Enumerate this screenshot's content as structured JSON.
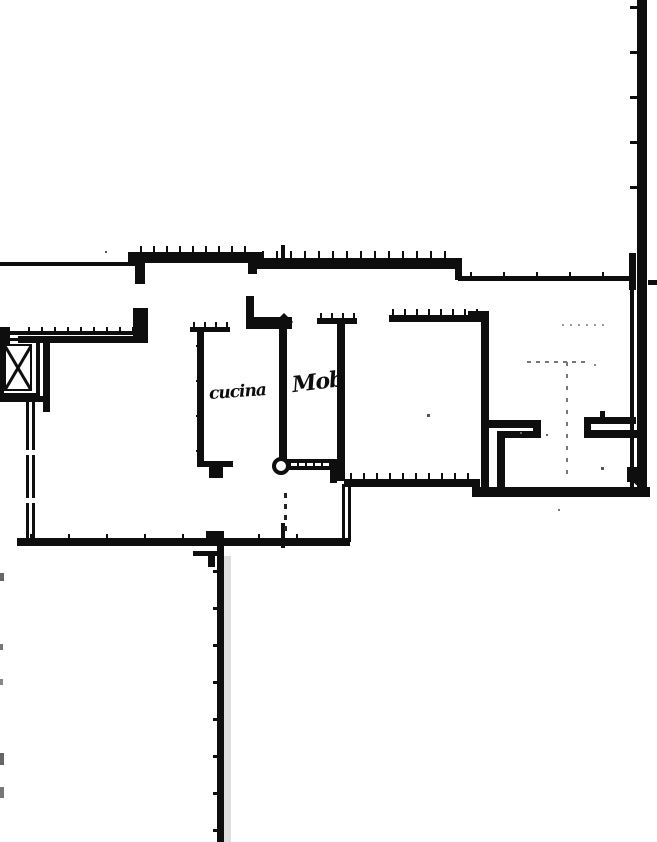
{
  "labels": {
    "kitchen": "cucina",
    "mob": "Mob"
  },
  "colors": {
    "paper": "#ffffff",
    "ink": "#0e0e0e",
    "faint": "#777777",
    "noise": "#999999",
    "shade": "#dedede"
  },
  "plan": {
    "width": 657,
    "height": 842,
    "walls": [
      {
        "x": 0,
        "y": 262,
        "w": 138,
        "h": 4
      },
      {
        "x": 128,
        "y": 252,
        "w": 134,
        "h": 11
      },
      {
        "x": 135,
        "y": 263,
        "w": 10,
        "h": 21
      },
      {
        "x": 248,
        "y": 263,
        "w": 9,
        "h": 11
      },
      {
        "x": 256,
        "y": 258,
        "w": 206,
        "h": 11
      },
      {
        "x": 281,
        "y": 245,
        "w": 4,
        "h": 14
      },
      {
        "x": 455,
        "y": 262,
        "w": 7,
        "h": 18
      },
      {
        "x": 458,
        "y": 276,
        "w": 175,
        "h": 5
      },
      {
        "x": 648,
        "y": 280,
        "w": 9,
        "h": 5
      },
      {
        "x": 637,
        "y": 0,
        "w": 10,
        "h": 497
      },
      {
        "x": 629,
        "y": 253,
        "w": 7,
        "h": 37
      },
      {
        "x": 630,
        "y": 290,
        "w": 4,
        "h": 198
      },
      {
        "x": 627,
        "y": 467,
        "w": 12,
        "h": 15
      },
      {
        "x": 472,
        "y": 487,
        "w": 178,
        "h": 10
      },
      {
        "x": 344,
        "y": 479,
        "w": 134,
        "h": 8
      },
      {
        "x": 472,
        "y": 479,
        "w": 8,
        "h": 10
      },
      {
        "x": 285,
        "y": 459,
        "w": 50,
        "h": 4
      },
      {
        "x": 285,
        "y": 466,
        "w": 50,
        "h": 4
      },
      {
        "x": 330,
        "y": 459,
        "w": 7,
        "h": 24
      },
      {
        "x": 190,
        "y": 327,
        "w": 40,
        "h": 5
      },
      {
        "x": 197,
        "y": 330,
        "w": 7,
        "h": 133
      },
      {
        "x": 197,
        "y": 461,
        "w": 36,
        "h": 6
      },
      {
        "x": 209,
        "y": 467,
        "w": 14,
        "h": 11
      },
      {
        "x": 246,
        "y": 296,
        "w": 8,
        "h": 27
      },
      {
        "x": 246,
        "y": 317,
        "w": 46,
        "h": 12
      },
      {
        "x": 279,
        "y": 329,
        "w": 8,
        "h": 130
      },
      {
        "x": 317,
        "y": 318,
        "w": 40,
        "h": 6
      },
      {
        "x": 337,
        "y": 324,
        "w": 8,
        "h": 157
      },
      {
        "x": 389,
        "y": 315,
        "w": 100,
        "h": 7
      },
      {
        "x": 468,
        "y": 311,
        "w": 21,
        "h": 11
      },
      {
        "x": 481,
        "y": 315,
        "w": 8,
        "h": 175
      },
      {
        "x": 489,
        "y": 420,
        "w": 52,
        "h": 8
      },
      {
        "x": 533,
        "y": 428,
        "w": 8,
        "h": 10
      },
      {
        "x": 497,
        "y": 431,
        "w": 44,
        "h": 7
      },
      {
        "x": 497,
        "y": 438,
        "w": 8,
        "h": 54
      },
      {
        "x": 584,
        "y": 417,
        "w": 52,
        "h": 7
      },
      {
        "x": 584,
        "y": 424,
        "w": 7,
        "h": 14
      },
      {
        "x": 591,
        "y": 430,
        "w": 51,
        "h": 8
      },
      {
        "x": 600,
        "y": 411,
        "w": 5,
        "h": 12
      },
      {
        "x": 17,
        "y": 538,
        "w": 333,
        "h": 8
      },
      {
        "x": 206,
        "y": 531,
        "w": 18,
        "h": 8
      },
      {
        "x": 342,
        "y": 484,
        "w": 3,
        "h": 58
      },
      {
        "x": 348,
        "y": 484,
        "w": 3,
        "h": 58
      },
      {
        "x": 217,
        "y": 540,
        "w": 7,
        "h": 302
      },
      {
        "x": 193,
        "y": 551,
        "w": 24,
        "h": 5
      },
      {
        "x": 208,
        "y": 551,
        "w": 7,
        "h": 16
      },
      {
        "x": 281,
        "y": 523,
        "w": 4,
        "h": 25
      },
      {
        "x": 4,
        "y": 331,
        "w": 144,
        "h": 4
      },
      {
        "x": 18,
        "y": 336,
        "w": 130,
        "h": 7
      },
      {
        "x": 0,
        "y": 327,
        "w": 10,
        "h": 18
      },
      {
        "x": 133,
        "y": 308,
        "w": 15,
        "h": 28
      },
      {
        "x": 0,
        "y": 338,
        "w": 37,
        "h": 3
      },
      {
        "x": 0,
        "y": 393,
        "w": 37,
        "h": 3
      },
      {
        "x": 0,
        "y": 338,
        "w": 4,
        "h": 58
      },
      {
        "x": 36,
        "y": 338,
        "w": 4,
        "h": 59
      },
      {
        "x": 43,
        "y": 338,
        "w": 7,
        "h": 59
      },
      {
        "x": 4,
        "y": 344,
        "w": 28,
        "h": 2
      },
      {
        "x": 4,
        "y": 389,
        "w": 28,
        "h": 2
      },
      {
        "x": 4,
        "y": 344,
        "w": 2,
        "h": 47
      },
      {
        "x": 30,
        "y": 344,
        "w": 2,
        "h": 47
      },
      {
        "x": 0,
        "y": 396,
        "w": 50,
        "h": 6
      },
      {
        "x": 26,
        "y": 402,
        "w": 3,
        "h": 138
      },
      {
        "x": 32,
        "y": 402,
        "w": 3,
        "h": 138
      },
      {
        "x": 43,
        "y": 402,
        "w": 7,
        "h": 10
      }
    ],
    "white_gaps": [
      {
        "x": 25,
        "y": 450,
        "w": 11,
        "h": 5
      },
      {
        "x": 25,
        "y": 498,
        "w": 11,
        "h": 5
      }
    ],
    "tick_runs": [
      {
        "axis": "v",
        "x1": 140,
        "x2": 254,
        "step": 13,
        "y": 246,
        "len": 7,
        "w": 2
      },
      {
        "axis": "v",
        "x1": 262,
        "x2": 456,
        "step": 14,
        "y": 251,
        "len": 8,
        "w": 2
      },
      {
        "axis": "v",
        "x1": 470,
        "x2": 620,
        "step": 33,
        "y": 272,
        "len": 9,
        "w": 2
      },
      {
        "axis": "h",
        "y1": 6,
        "y2": 230,
        "step": 45,
        "x": 630,
        "len": 8,
        "w": 3
      },
      {
        "axis": "v",
        "x1": 392,
        "x2": 486,
        "step": 12,
        "y": 309,
        "len": 7,
        "w": 2
      },
      {
        "axis": "v",
        "x1": 350,
        "x2": 470,
        "step": 13,
        "y": 473,
        "len": 7,
        "w": 2
      },
      {
        "axis": "v",
        "x1": 30,
        "x2": 330,
        "step": 38,
        "y": 534,
        "len": 9,
        "w": 2
      },
      {
        "axis": "h",
        "y1": 570,
        "y2": 830,
        "step": 37,
        "x": 213,
        "len": 10,
        "w": 3
      },
      {
        "axis": "v",
        "x1": 28,
        "x2": 140,
        "step": 13,
        "y": 327,
        "len": 6,
        "w": 2
      },
      {
        "axis": "v",
        "x1": 289,
        "x2": 331,
        "step": 8,
        "y": 460,
        "len": 9,
        "w": 2
      },
      {
        "axis": "v",
        "x1": 193,
        "x2": 227,
        "step": 11,
        "y": 322,
        "len": 6,
        "w": 2
      },
      {
        "axis": "v",
        "x1": 320,
        "x2": 354,
        "step": 11,
        "y": 313,
        "len": 6,
        "w": 2
      },
      {
        "axis": "v",
        "x1": 505,
        "x2": 630,
        "step": 28,
        "y": 489,
        "len": 8,
        "w": 2
      },
      {
        "axis": "h",
        "y1": 345,
        "y2": 450,
        "step": 35,
        "x": 196,
        "len": 6,
        "w": 2
      }
    ],
    "dashes": [
      {
        "x": 284,
        "y1": 493,
        "y2": 532,
        "seg": 5,
        "gap": 6,
        "w": 3,
        "c": "#222222"
      },
      {
        "x": 566,
        "y1": 362,
        "y2": 476,
        "seg": 4,
        "gap": 8,
        "w": 2,
        "c": "#777777"
      },
      {
        "y": 361,
        "x1": 527,
        "x2": 582,
        "seg": 4,
        "gap": 5,
        "h": 2,
        "c": "#777777"
      },
      {
        "y": 324,
        "x1": 562,
        "x2": 608,
        "seg": 2,
        "gap": 6,
        "h": 2,
        "c": "#999999"
      }
    ],
    "dots": [
      {
        "x": 427,
        "y": 414,
        "s": 3,
        "c": "#555555"
      },
      {
        "x": 520,
        "y": 432,
        "s": 2,
        "c": "#666666"
      },
      {
        "x": 546,
        "y": 434,
        "s": 2,
        "c": "#666666"
      },
      {
        "x": 558,
        "y": 509,
        "s": 2,
        "c": "#777777"
      },
      {
        "x": 601,
        "y": 467,
        "s": 3,
        "c": "#555555"
      },
      {
        "x": 105,
        "y": 251,
        "s": 2,
        "c": "#555555"
      },
      {
        "x": 594,
        "y": 364,
        "s": 2,
        "c": "#888888"
      }
    ],
    "light_rects": [
      {
        "x": 224,
        "y": 556,
        "w": 7,
        "h": 286,
        "c": "#dedede"
      },
      {
        "x": 0,
        "y": 573,
        "w": 4,
        "h": 8,
        "c": "#666666"
      },
      {
        "x": 0,
        "y": 644,
        "w": 3,
        "h": 6,
        "c": "#777777"
      },
      {
        "x": 0,
        "y": 679,
        "w": 3,
        "h": 6,
        "c": "#888888"
      },
      {
        "x": 0,
        "y": 753,
        "w": 4,
        "h": 12,
        "c": "#666666"
      },
      {
        "x": 0,
        "y": 787,
        "w": 4,
        "h": 11,
        "c": "#777777"
      }
    ],
    "rings": [
      {
        "cx": 281,
        "cy": 466,
        "r": 9,
        "ring": 4
      }
    ],
    "diamonds": [
      {
        "cx": 284,
        "cy": 322,
        "r": 9
      }
    ],
    "xlines": [
      {
        "x1": 5,
        "y1": 346,
        "x2": 31,
        "y2": 390
      },
      {
        "x1": 31,
        "y1": 346,
        "x2": 5,
        "y2": 390
      }
    ],
    "arcs": [
      {
        "d": "M 629 469 Q 632 485 646 488"
      }
    ]
  }
}
